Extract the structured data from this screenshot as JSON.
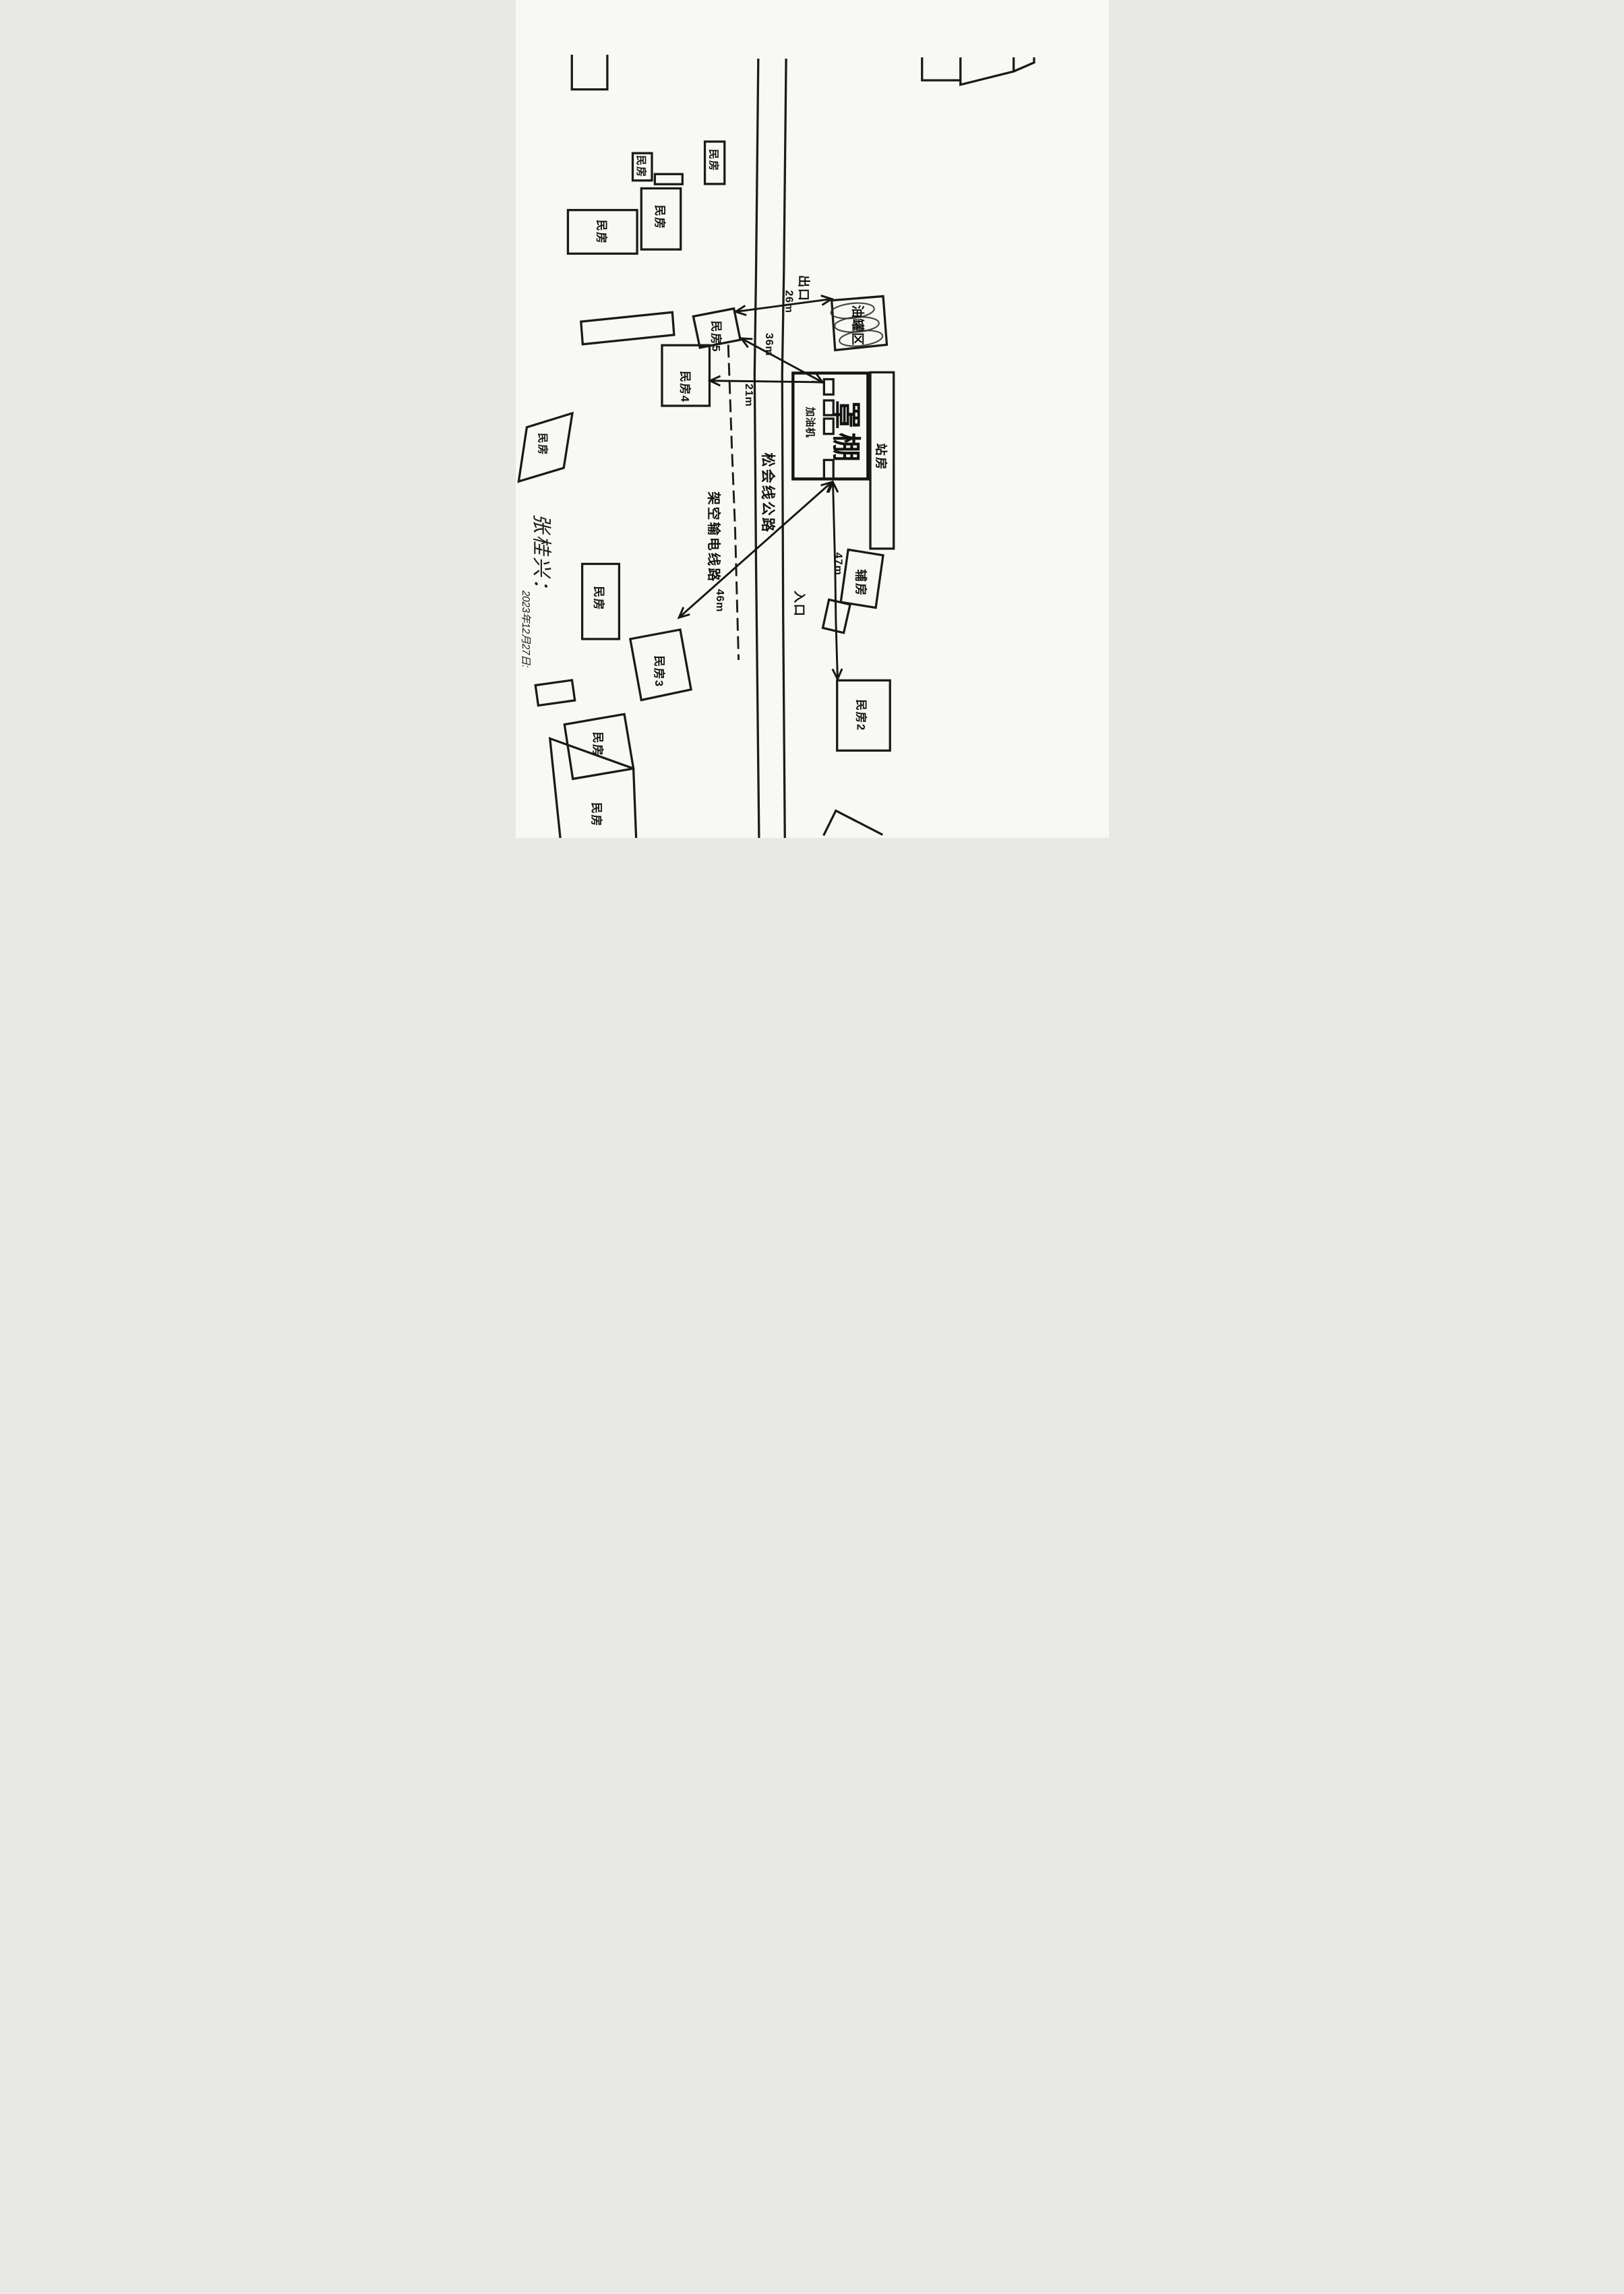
{
  "page": {
    "ink": "#1a1a1a",
    "paper": "#f8f8f5"
  },
  "handwriting": {
    "signature": "张桂兴：",
    "date": "2023年12月27日:"
  },
  "roads": {
    "highway": "松会线公路",
    "power_line": "架空输电线路",
    "exit": "出口",
    "entrance": "入口"
  },
  "station": {
    "canopy": "罩棚",
    "dispenser": "加油机",
    "station_house": "站房",
    "tank_area": "油罐区",
    "auxiliary": "辅房"
  },
  "houses": {
    "generic": "民房",
    "no2": "民房2",
    "no3": "民房3",
    "no4": "民房4",
    "no5": "民房5"
  },
  "distances": {
    "house5_to_exit": "26m",
    "house5_to_dispenser": "36m",
    "house4_to_dispenser": "21m",
    "dispenser_to_house2": "47m",
    "dispenser_to_house3": "46m"
  }
}
